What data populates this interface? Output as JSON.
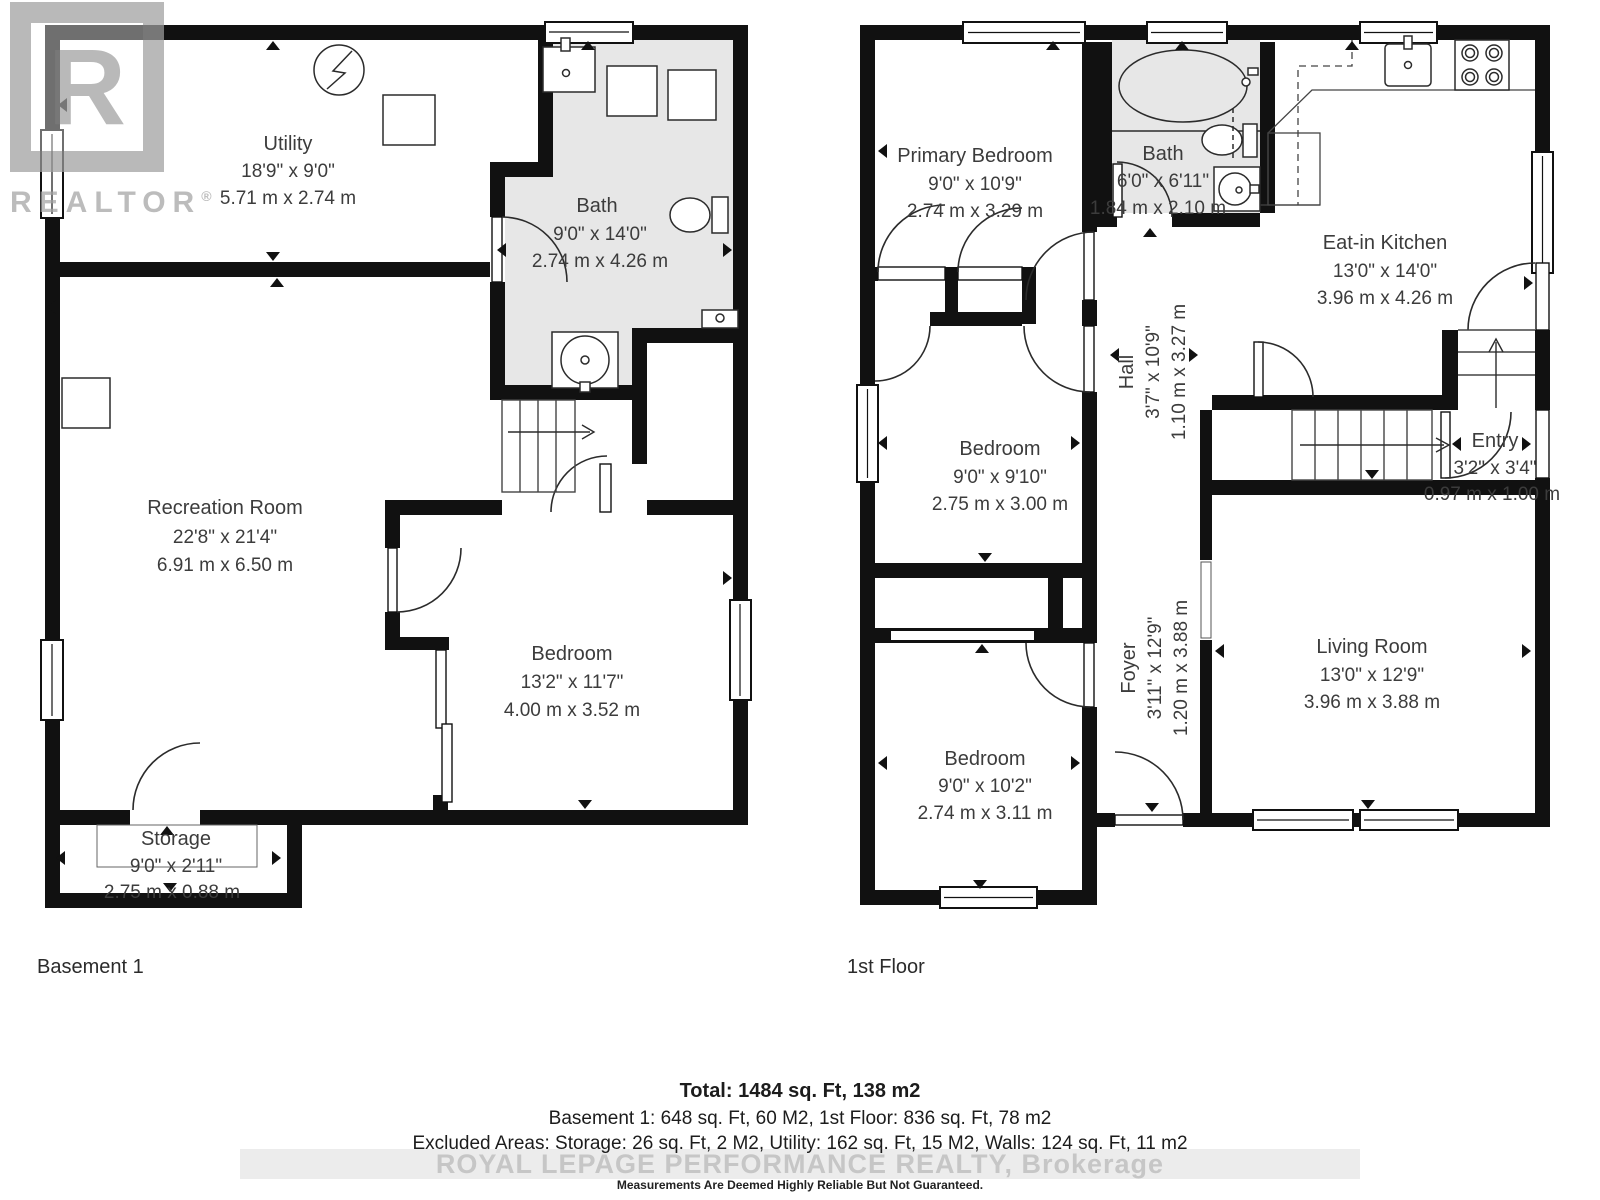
{
  "watermarks": {
    "realtor_logo_letter": "R",
    "realtor_logo_text": "REALTOR",
    "realtor_reg_mark": "®",
    "brokerage_line": "ROYAL LEPAGE PERFORMANCE REALTY, Brokerage"
  },
  "floors": [
    {
      "label": "Basement 1",
      "rooms": [
        {
          "name": "Utility",
          "imperial": "18'9\" x 9'0\"",
          "metric": "5.71 m x 2.74 m"
        },
        {
          "name": "Bath",
          "imperial": "9'0\" x 14'0\"",
          "metric": "2.74 m x 4.26 m"
        },
        {
          "name": "Recreation Room",
          "imperial": "22'8\" x 21'4\"",
          "metric": "6.91 m x 6.50 m"
        },
        {
          "name": "Bedroom",
          "imperial": "13'2\" x 11'7\"",
          "metric": "4.00 m x 3.52 m"
        },
        {
          "name": "Storage",
          "imperial": "9'0\" x 2'11\"",
          "metric": "2.75 m x 0.88 m"
        }
      ]
    },
    {
      "label": "1st Floor",
      "rooms": [
        {
          "name": "Primary Bedroom",
          "imperial": "9'0\" x 10'9\"",
          "metric": "2.74 m x 3.29 m"
        },
        {
          "name": "Bath",
          "imperial": "6'0\" x 6'11\"",
          "metric": "1.84 m x 2.10 m"
        },
        {
          "name": "Eat-in Kitchen",
          "imperial": "13'0\" x 14'0\"",
          "metric": "3.96 m x 4.26 m"
        },
        {
          "name": "Hall",
          "imperial": "3'7\" x 10'9\"",
          "metric": "1.10 m x 3.27 m"
        },
        {
          "name": "Entry",
          "imperial": "3'2\" x 3'4\"",
          "metric": "0.97 m x 1.00 m"
        },
        {
          "name": "Bedroom",
          "imperial": "9'0\" x 9'10\"",
          "metric": "2.75 m x 3.00 m"
        },
        {
          "name": "Foyer",
          "imperial": "3'11\" x 12'9\"",
          "metric": "1.20 m x 3.88 m"
        },
        {
          "name": "Bedroom",
          "imperial": "9'0\" x 10'2\"",
          "metric": "2.74 m x 3.11 m"
        },
        {
          "name": "Living Room",
          "imperial": "13'0\" x 12'9\"",
          "metric": "3.96 m x 3.88 m"
        }
      ]
    }
  ],
  "footer": {
    "total": "Total: 1484 sq. Ft, 138 m2",
    "floor_areas": "Basement 1: 648 sq. Ft, 60 M2, 1st Floor: 836 sq. Ft, 78 m2",
    "excluded": "Excluded Areas: Storage: 26 sq. Ft, 2 M2, Utility: 162 sq. Ft, 15 M2, Walls: 124 sq. Ft, 11 m2",
    "disclaimer": "Measurements Are Deemed Highly Reliable But Not Guaranteed."
  },
  "colors": {
    "wall": "#111111",
    "bath_fill": "#e7e7e7",
    "text": "#3c3c3c",
    "watermark_gray": "#9f9f9f"
  }
}
